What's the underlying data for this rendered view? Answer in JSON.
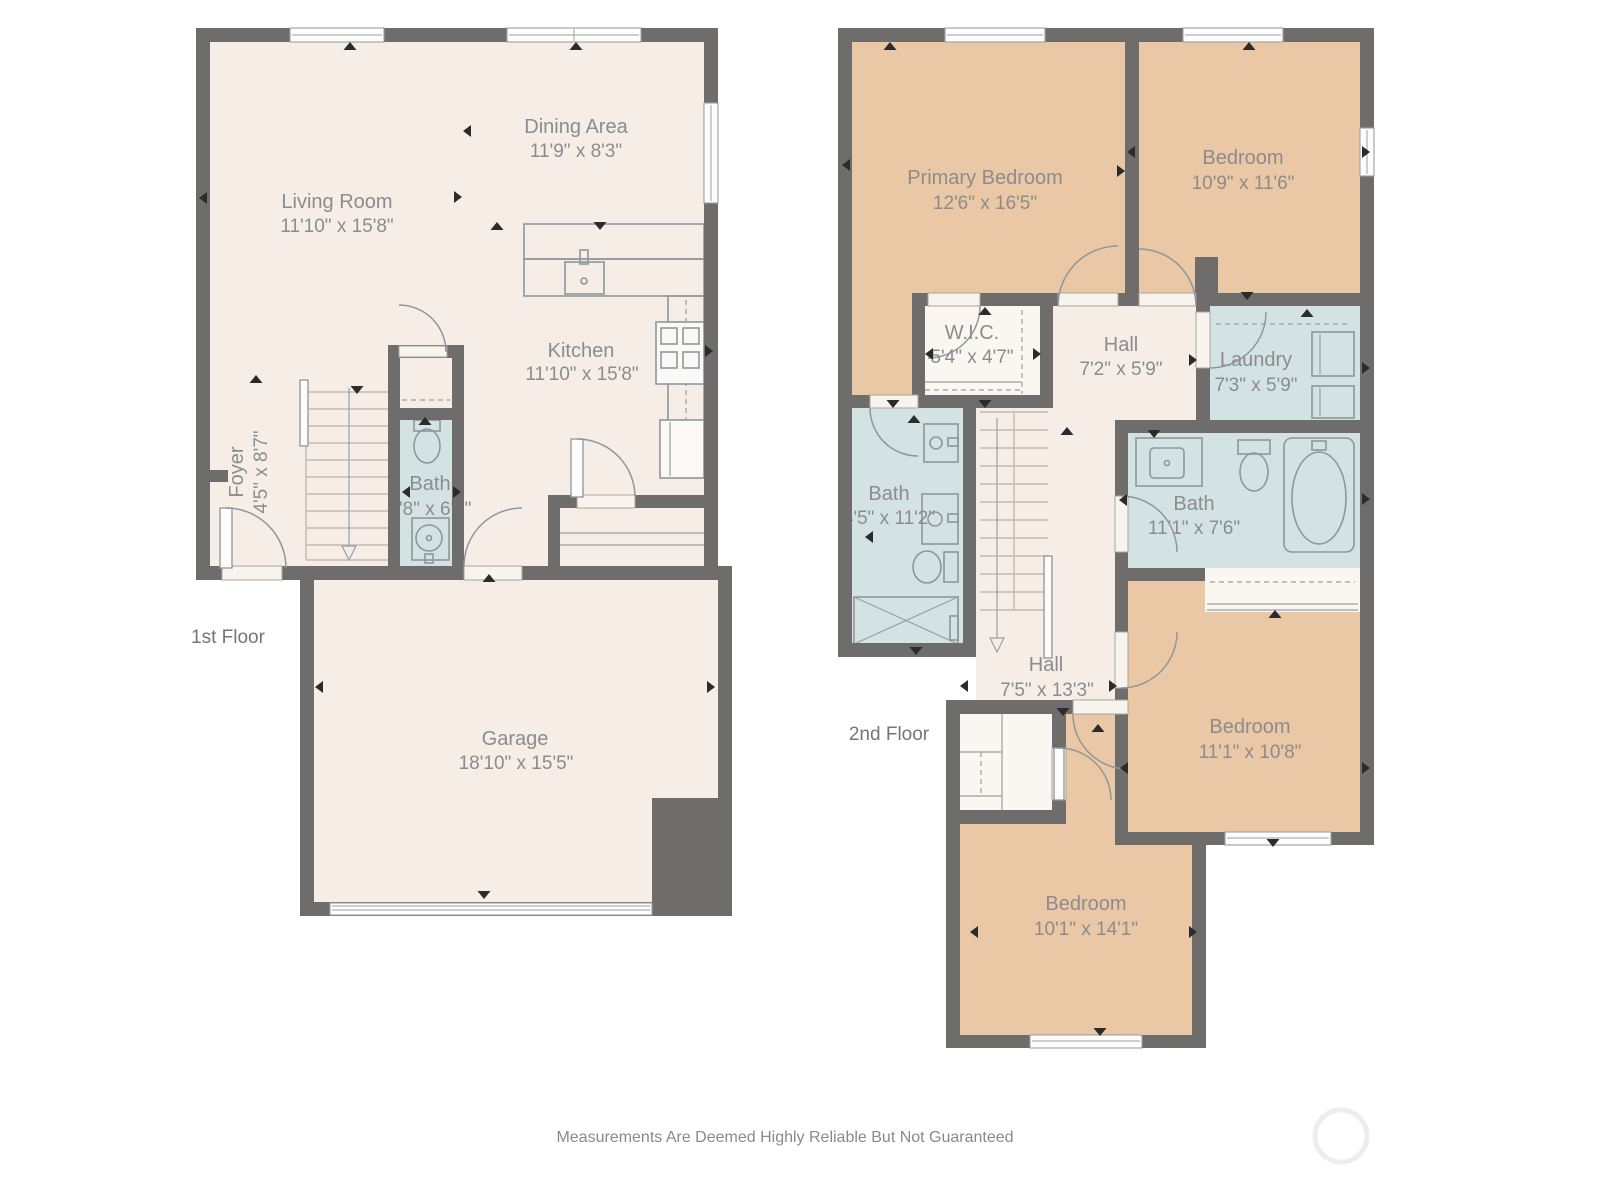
{
  "title": "Two-story residential floor plan",
  "floors": [
    {
      "label": "1st Floor",
      "rooms": [
        {
          "name": "Living Room",
          "dims": "11'10\" x 15'8\""
        },
        {
          "name": "Dining Area",
          "dims": "11'9\" x 8'3\""
        },
        {
          "name": "Kitchen",
          "dims": "11'10\" x 15'8\""
        },
        {
          "name": "Foyer",
          "dims": "4'5\" x 8'7\""
        },
        {
          "name": "Bath",
          "dims": "2'8\" x 6'9\""
        },
        {
          "name": "Garage",
          "dims": "18'10\" x 15'5\""
        }
      ]
    },
    {
      "label": "2nd Floor",
      "rooms": [
        {
          "name": "Primary Bedroom",
          "dims": "12'6\" x 16'5\""
        },
        {
          "name": "Bedroom",
          "dims": "10'9\" x 11'6\""
        },
        {
          "name": "W.I.C.",
          "dims": "5'4\" x 4'7\""
        },
        {
          "name": "Hall",
          "dims": "7'2\" x 5'9\""
        },
        {
          "name": "Laundry",
          "dims": "7'3\" x 5'9\""
        },
        {
          "name": "Bath",
          "dims": "4'5\" x 11'2\""
        },
        {
          "name": "Bath",
          "dims": "11'1\" x 7'6\""
        },
        {
          "name": "Hall",
          "dims": "7'5\" x 13'3\""
        },
        {
          "name": "Bedroom",
          "dims": "11'1\" x 10'8\""
        },
        {
          "name": "Bedroom",
          "dims": "10'1\" x 14'1\""
        }
      ]
    }
  ],
  "footer": {
    "disclaimer": "Measurements Are Deemed Highly Reliable But Not Guaranteed"
  },
  "colors": {
    "wall": "#6f6d6b",
    "cream": "#f6ede6",
    "orange": "#eac8a5",
    "blue": "#d3e3e4",
    "fixline": "#8e979b",
    "labeltext": "#8c8c8c",
    "floortext": "#757575"
  }
}
